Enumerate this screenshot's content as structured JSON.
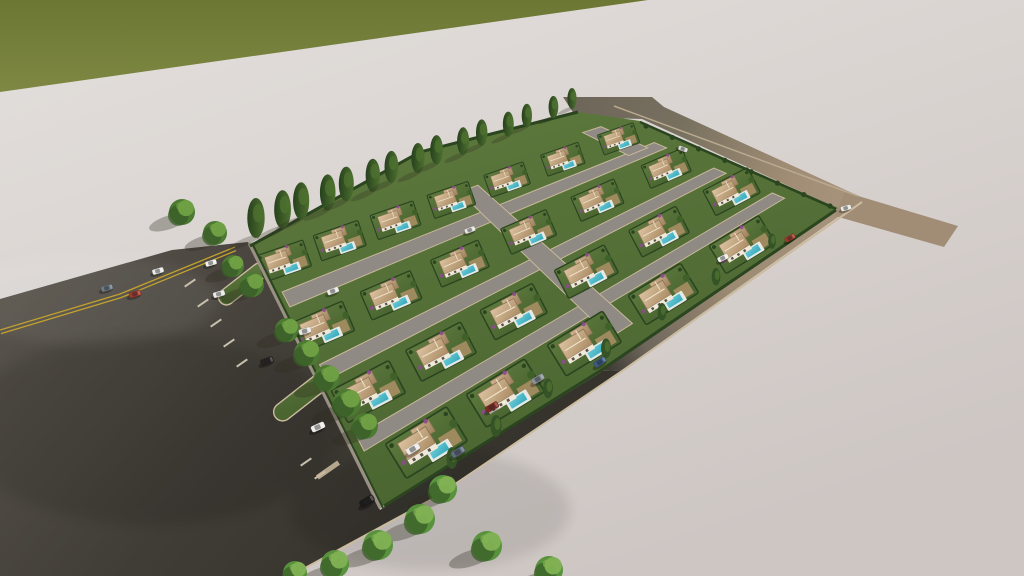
{
  "scene": {
    "description": "aerial-3d-render-villa-development",
    "canvas": {
      "w": 1024,
      "h": 576
    },
    "palette": {
      "groundA": "#e3dfdc",
      "groundB": "#d8d2cf",
      "groundC": "#cdc6c3",
      "grassA": "#6b7733",
      "grassB": "#7e8843",
      "asphaltA": "#57534b",
      "asphaltB": "#403c36",
      "asphaltC": "#36332d",
      "tanA": "#a8947c",
      "tanB": "#9c8a72",
      "tanC": "#6f675c",
      "stub": "#6e6659",
      "eastStub": "#a18d76",
      "curb": "#cbbb9f",
      "curbSoft": "#bfb098",
      "dash": "#c9c0ae",
      "yellow": "#c2a12f",
      "gardenA": "#5e7a3e",
      "gardenB": "#4a6530",
      "hedge": "#2a451f",
      "street": "#8f8a83",
      "streetCurb": "#c8b89a",
      "roofA": "#dcc3a1",
      "roofB": "#aa8b63",
      "roofC": "#d0b491",
      "roofD": "#9d805c",
      "ridge": "#eee0c8",
      "wall": "#f0e9da",
      "window": "#5a5147",
      "poolA": "#6fccd8",
      "poolB": "#35a8ba",
      "deck": "#e9e8e3",
      "drive": "#ad9166",
      "cypA": "#27411d",
      "cypB": "#4e7030",
      "treeBase": "#4c7a33",
      "treeShade": "#3a5c28",
      "treeLight": "#71a145",
      "treeBaseL": "#58923c",
      "treeLightL": "#82b254",
      "bougain": "#8d4a8f",
      "shadow": "rgba(48,42,32,0.32)",
      "wallLine": "#9a9083"
    },
    "grass": {
      "points": [
        [
          0,
          0
        ],
        [
          648,
          0
        ],
        [
          0,
          92
        ]
      ]
    },
    "roads": {
      "main": [
        [
          0,
          299
        ],
        [
          172,
          250
        ],
        [
          248,
          242
        ],
        [
          380,
          510
        ],
        [
          600,
          371
        ],
        [
          622,
          370
        ],
        [
          436,
          498
        ],
        [
          290,
          576
        ],
        [
          0,
          576
        ]
      ],
      "se": [
        [
          838,
          208
        ],
        [
          862,
          200
        ],
        [
          622,
          370
        ],
        [
          600,
          371
        ]
      ],
      "ne_stub": [
        [
          563,
          97
        ],
        [
          652,
          97
        ],
        [
          664,
          107
        ],
        [
          861,
          197
        ],
        [
          839,
          209
        ],
        [
          642,
          119
        ],
        [
          576,
          117
        ]
      ],
      "east_stub": [
        [
          845,
          192
        ],
        [
          958,
          226
        ],
        [
          944,
          247
        ],
        [
          835,
          216
        ]
      ]
    },
    "markings": {
      "yellow_line": [
        [
          0,
          330
        ],
        [
          120,
          294
        ],
        [
          235,
          247
        ]
      ],
      "se_curb": [
        [
          862,
          202
        ],
        [
          625,
          369
        ],
        [
          436,
          497
        ],
        [
          292,
          575
        ]
      ],
      "ne_curb": [
        [
          614,
          106
        ],
        [
          858,
          196
        ]
      ],
      "inner_curb": [
        [
          380,
          508
        ],
        [
          600,
          372
        ]
      ],
      "stall_dashes": [
        [
          190,
          283
        ],
        [
          203,
          303
        ],
        [
          216,
          323
        ],
        [
          229,
          343
        ],
        [
          242,
          363
        ],
        [
          306,
          462
        ],
        [
          320,
          475
        ]
      ],
      "dash_angle": -35,
      "cap_stripe": [
        328,
        470,
        -35
      ]
    },
    "islands": [
      {
        "cx": 243,
        "cy": 284,
        "w": 16,
        "len": 58,
        "rot": 52
      },
      {
        "cx": 326,
        "cy": 378,
        "w": 18,
        "len": 128,
        "rot": 52
      }
    ],
    "compound": {
      "quad": [
        [
          254,
          250
        ],
        [
          622,
          126
        ],
        [
          828,
          212
        ],
        [
          382,
          503
        ]
      ],
      "outline": [
        [
          250,
          246
        ],
        [
          420,
          152
        ],
        [
          578,
          112
        ],
        [
          640,
          121
        ],
        [
          838,
          208
        ],
        [
          600,
          371
        ],
        [
          382,
          506
        ]
      ],
      "streets": [
        {
          "fv0": 0.175,
          "fv1": 0.235
        },
        {
          "fv0": 0.465,
          "fv1": 0.525
        },
        {
          "fv0": 0.75,
          "fv1": 0.81
        }
      ],
      "street_fu": [
        0.015,
        0.99
      ],
      "connectors": [
        {
          "fu0": 0.535,
          "fu1": 0.585,
          "fv0": 0.05,
          "fv1": 0.94
        },
        {
          "fu0": 0.915,
          "fu1": 0.965,
          "fv0": -0.04,
          "fv1": 0.19
        }
      ],
      "rows": [
        {
          "fv": 0.075,
          "count": 7,
          "fu0": 0.055,
          "fu1": 0.95
        },
        {
          "fv": 0.35,
          "count": 6,
          "fu0": 0.06,
          "fu1": 0.93
        },
        {
          "fv": 0.635,
          "count": 6,
          "fu0": 0.08,
          "fu1": 0.95
        },
        {
          "fv": 0.905,
          "count": 5,
          "fu0": 0.13,
          "fu1": 0.85
        }
      ],
      "hedges": {
        "nw": [
          [
            250,
            246
          ],
          [
            420,
            152
          ],
          [
            578,
            112
          ]
        ],
        "sw": [
          [
            249,
            243
          ],
          [
            380,
            508
          ]
        ],
        "se": [
          [
            836,
            210
          ],
          [
            600,
            371
          ],
          [
            384,
            506
          ]
        ],
        "ne": [
          [
            640,
            122
          ],
          [
            836,
            209
          ]
        ]
      }
    },
    "cypresses": {
      "from": [
        258,
        236
      ],
      "to": [
        574,
        107
      ],
      "count": 15,
      "h0": 40,
      "h1": 21
    },
    "ne_shrubs": {
      "from": [
        646,
        126
      ],
      "to": [
        830,
        206
      ],
      "count": 8
    },
    "se_trees": [
      [
        772,
        244,
        7
      ],
      [
        716,
        280,
        8
      ],
      [
        662,
        315,
        8
      ],
      [
        606,
        352,
        9
      ],
      [
        548,
        392,
        9
      ],
      [
        496,
        430,
        10
      ],
      [
        452,
        462,
        10
      ]
    ],
    "trees": [
      [
        182,
        212,
        13,
        0
      ],
      [
        215,
        233,
        12,
        0
      ],
      [
        233,
        266,
        11,
        0
      ],
      [
        252,
        285,
        12,
        0
      ],
      [
        287,
        330,
        12,
        0
      ],
      [
        307,
        353,
        13,
        0
      ],
      [
        327,
        378,
        13,
        0
      ],
      [
        347,
        403,
        14,
        0
      ],
      [
        365,
        426,
        13,
        0
      ],
      [
        443,
        489,
        14,
        1
      ],
      [
        420,
        519,
        15,
        1
      ],
      [
        378,
        545,
        15,
        1
      ],
      [
        335,
        564,
        14,
        1
      ],
      [
        487,
        546,
        15,
        1
      ],
      [
        549,
        570,
        14,
        1
      ],
      [
        295,
        573,
        12,
        1
      ]
    ],
    "cars": [
      [
        107,
        288,
        -16,
        "#6e7a84"
      ],
      [
        135,
        294,
        -16,
        "#a2392b"
      ],
      [
        158,
        271,
        -16,
        "#ececea"
      ],
      [
        211,
        263,
        -16,
        "#f0efec"
      ],
      [
        219,
        294,
        -16,
        "#eceae6"
      ],
      [
        305,
        331,
        -16,
        "#e9e8e4"
      ],
      [
        267,
        361,
        -20,
        "#25221f"
      ],
      [
        318,
        427,
        -24,
        "#f0eeea"
      ],
      [
        367,
        501,
        -31,
        "#1d1b19"
      ],
      [
        413,
        449,
        -31,
        "#eceae6"
      ],
      [
        458,
        452,
        -31,
        "#5d6b7d"
      ],
      [
        600,
        362,
        -33,
        "#3c5a85"
      ],
      [
        790,
        238,
        -28,
        "#9e3a2c"
      ],
      [
        846,
        208,
        -15,
        "#eae9e5"
      ],
      [
        683,
        149,
        20,
        "#d8d8d4"
      ],
      [
        333,
        291,
        -20,
        "#eceae6"
      ],
      [
        470,
        230,
        -20,
        "#e6e5e1"
      ],
      [
        723,
        258,
        -26,
        "#efeeea"
      ],
      [
        538,
        379,
        -30,
        "#8a9096"
      ],
      [
        492,
        407,
        -30,
        "#7e2a22"
      ]
    ]
  }
}
